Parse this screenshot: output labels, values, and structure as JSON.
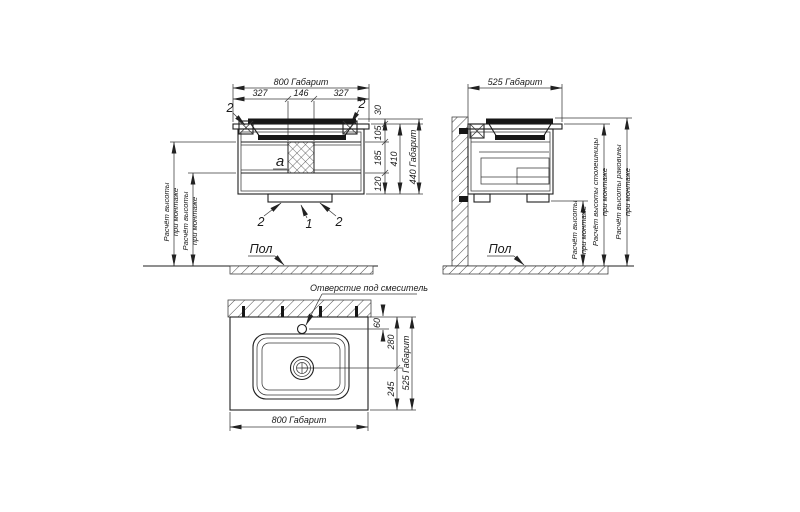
{
  "front_view": {
    "dim_width_total": "800 Габарит",
    "dim_left_segment": "327",
    "dim_center_segment": "146",
    "dim_right_segment": "327",
    "dim_rim_height": "30",
    "dim_sink_depth": "105",
    "dim_middle_section": "185",
    "dim_bottom_section": "120",
    "dim_cabinet_height": "410",
    "dim_height_total": "440 Габарит",
    "callout_bracket_left": "2",
    "callout_bracket_right": "2",
    "callout_plinth_left": "2",
    "callout_plinth_center": "1",
    "callout_plinth_right": "2",
    "label_siphon_area": "а",
    "mount_height_note_line1": "Расчёт высоты",
    "mount_height_note_line2": "при монтаже",
    "floor_label": "Пол"
  },
  "side_view": {
    "dim_depth_total": "525 Габарит",
    "mount_height_note_line1": "Расчёт высоты",
    "mount_height_note_line2": "при монтаже",
    "countertop_height_note_line1": "Расчёт высоты столешницы",
    "countertop_height_note_line2": "при монтаже",
    "sink_height_note_line1": "Расчёт высоты раковины",
    "sink_height_note_line2": "при монтаже",
    "floor_label": "Пол"
  },
  "top_view": {
    "faucet_hole_note": "Отверстие под смеситель",
    "dim_faucet_offset": "60",
    "dim_back_to_drain": "280",
    "dim_drain_to_front": "245",
    "dim_depth_total": "525 Габарит",
    "dim_width_total": "800 Габарит"
  }
}
